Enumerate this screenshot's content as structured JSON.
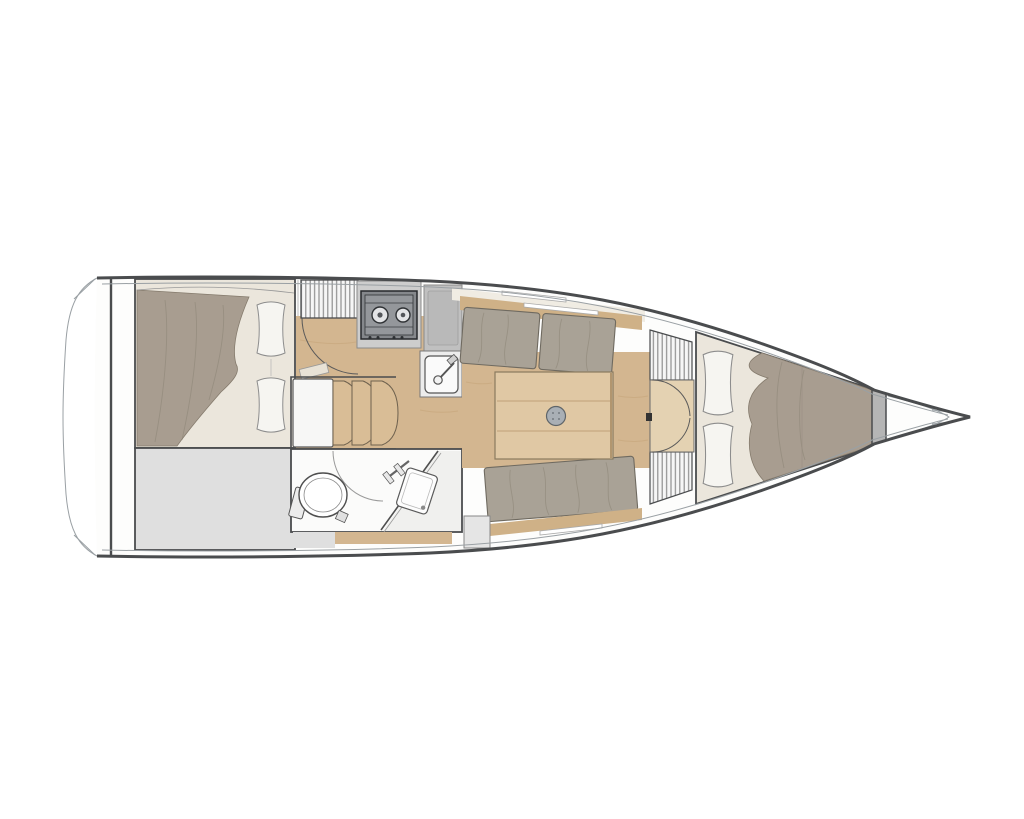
{
  "diagram": {
    "type": "boat-interior-floor-plan",
    "view": "top-down",
    "orientation": "bow-right",
    "areas": {
      "swim_platform": "transom swim platform",
      "aft_cabin": "aft double-berth cabin",
      "aft_storage": "aft storage locker",
      "galley": "galley with two-burner stove, worktop and sink",
      "companionway": "companionway with three curved steps",
      "head": "head compartment with toilet, shower screen and washbasin",
      "saloon": "saloon with centre table and facing settees",
      "forward_lockers": "louvered lockers at forward bulkhead with double doors",
      "forward_cabin": "forward V-berth cabin",
      "anchor_locker": "bow anchor locker with roller"
    },
    "counts": {
      "stove_burners": 2,
      "companionway_steps": 3,
      "aft_pillows": 2,
      "forward_pillows": 2,
      "settee_cushion_sections": 3,
      "table_planks": 3
    }
  },
  "colors": {
    "page_bg": "#ffffff",
    "hull_line": "#4a4c4e",
    "hull_inner_line": "#9aa0a4",
    "deck_white": "#fdfdfc",
    "cream_strip": "#f0ece3",
    "wood_floor": "#d3b690",
    "wood_shelf": "#cfb187",
    "wood_table": "#e0c8a4",
    "wood_step": "#d9bd96",
    "wood_door_floor": "#e4d2b2",
    "cushion": "#a9a296",
    "blanket": "#a89d90",
    "pillow": "#f6f5f1",
    "mattress": "#ebe6dc",
    "storage_gray": "#dfdfdf",
    "unit_gray": "#cdcdcd",
    "worktop_gray": "#c0c0c0",
    "stove_body": "#85888c",
    "stove_top": "#94979b",
    "stove_ring": "#e3e4e6",
    "sink_box": "#ececec",
    "sink_basin": "#fafafa",
    "louver_bg": "#f6f6f6",
    "louver_line": "#8f8f8f",
    "bulkhead_gray": "#b5b5b5",
    "mast_foot": "#a9afb5",
    "head_floor": "#fbfbfa",
    "head_right_zone": "#f0f0ee",
    "toilet": "#ffffff",
    "gray_box": "#e5e5e5"
  }
}
